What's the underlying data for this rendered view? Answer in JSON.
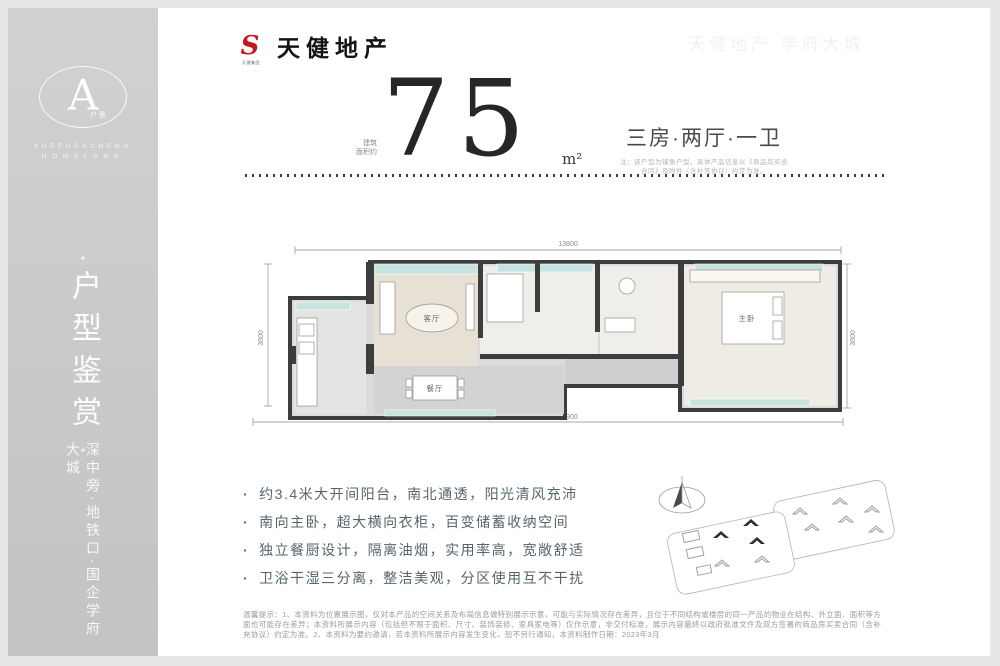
{
  "sidebar": {
    "badge": {
      "letter": "A",
      "sub": "户型",
      "caption_line1": "XUEFUDACHENG",
      "caption_line2": "HOMELAND"
    },
    "ornament": "◈",
    "title_vertical": "户型鉴赏",
    "slogan_vertical": "深中旁·地铁口·国企学府大城"
  },
  "header": {
    "brand": "天健地产",
    "brand_icon": "S",
    "brand_icon_caption": "天健集团",
    "watermark": "天健地产 学府大城",
    "area_prefix_line1": "建筑",
    "area_prefix_line2": "面积约",
    "area_value": "75",
    "area_unit": "m²",
    "layout_title": "三房·两厅·一卫",
    "layout_note_line1": "注：该户型为镜像户型，具体产品信息以《商品房买卖",
    "layout_note_line2": "合同》及附件（含补充协议）约定为准。"
  },
  "floorplan": {
    "dim_top": "13800",
    "dim_bottom": "13900",
    "dim_left": "3600",
    "dim_right": "3600",
    "room_living": "客厅",
    "room_dining": "餐厅",
    "room_master": "主卧"
  },
  "features": {
    "items": [
      "约3.4米大开间阳台，南北通透，阳光清风充沛",
      "南向主卧，超大横向衣柜，百变储蓄收纳空间",
      "独立餐厨设计，隔离油烟，实用率高，宽敞舒适",
      "卫浴干湿三分离，整洁美观，分区使用互不干扰"
    ]
  },
  "footer": {
    "disclaimer": "温馨提示：1、本资料为位置展示图，仅对本产品的空间关系及布局信息做特别展示示意，可能与实际情况存在差异，且位于不同结构或楼层的同一产品的物业在结构、外立面、面积等方面也可能存在差异；本资料所展示内容（包括但不限于面积、尺寸、装饰装修、家具家电等）仅作示意，非交付标准，展示内容最终以政府批准文件及双方签署的商品房买卖合同（含补充协议）约定为准。2、本资料为要约邀请，若本资料所展示内容发生变化，恕不另行通知，本资料制作日期：2023年3月"
  },
  "colors": {
    "brand_red": "#c8161d",
    "balcony_teal": "#c6e3df",
    "sidebar_gray": "#c9c9c9",
    "wall_dark": "#3d3d3d"
  }
}
